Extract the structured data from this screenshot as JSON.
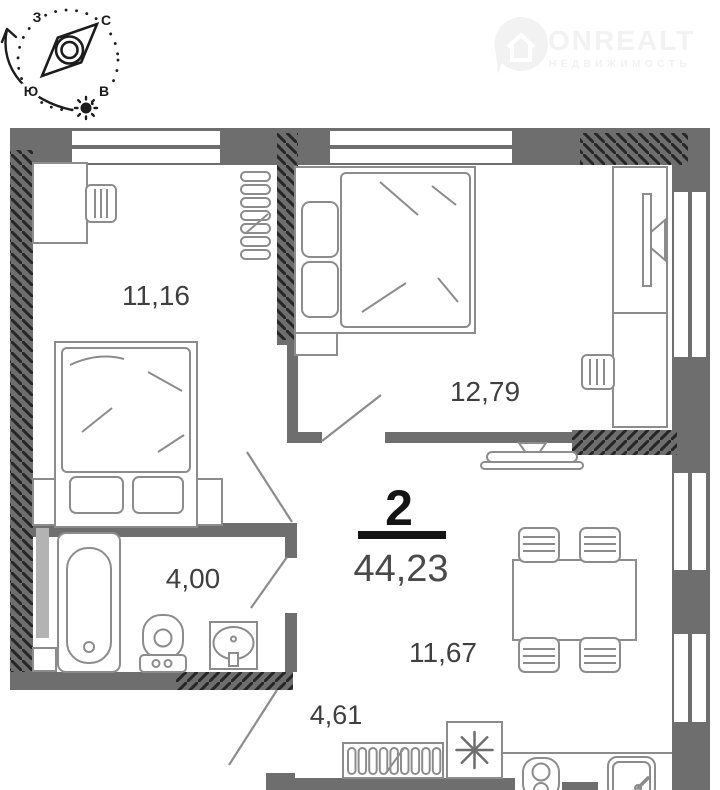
{
  "header": {
    "compass": {
      "west": "З",
      "north": "С",
      "south": "Ю",
      "east": "В"
    },
    "logo": {
      "brand": "ONREALT",
      "tagline": "НЕДВИЖИМОСТЬ"
    }
  },
  "plan": {
    "rooms_count": "2",
    "total_area": "44,23",
    "rooms": [
      {
        "name": "bedroom-1",
        "area": "11,16"
      },
      {
        "name": "bedroom-2",
        "area": "12,79"
      },
      {
        "name": "bathroom",
        "area": "4,00"
      },
      {
        "name": "kitchen-living-room",
        "area": "11,67"
      },
      {
        "name": "hallway",
        "area": "4,61"
      }
    ]
  },
  "colors": {
    "wall": "#6e6e6e",
    "hatch": "#262626",
    "furniture_outline": "#8c8c8c",
    "label": "#3f3f3f",
    "accent_black": "#141414",
    "duct_gray": "#b3b3b3",
    "watermark": "#f2f2f2"
  }
}
